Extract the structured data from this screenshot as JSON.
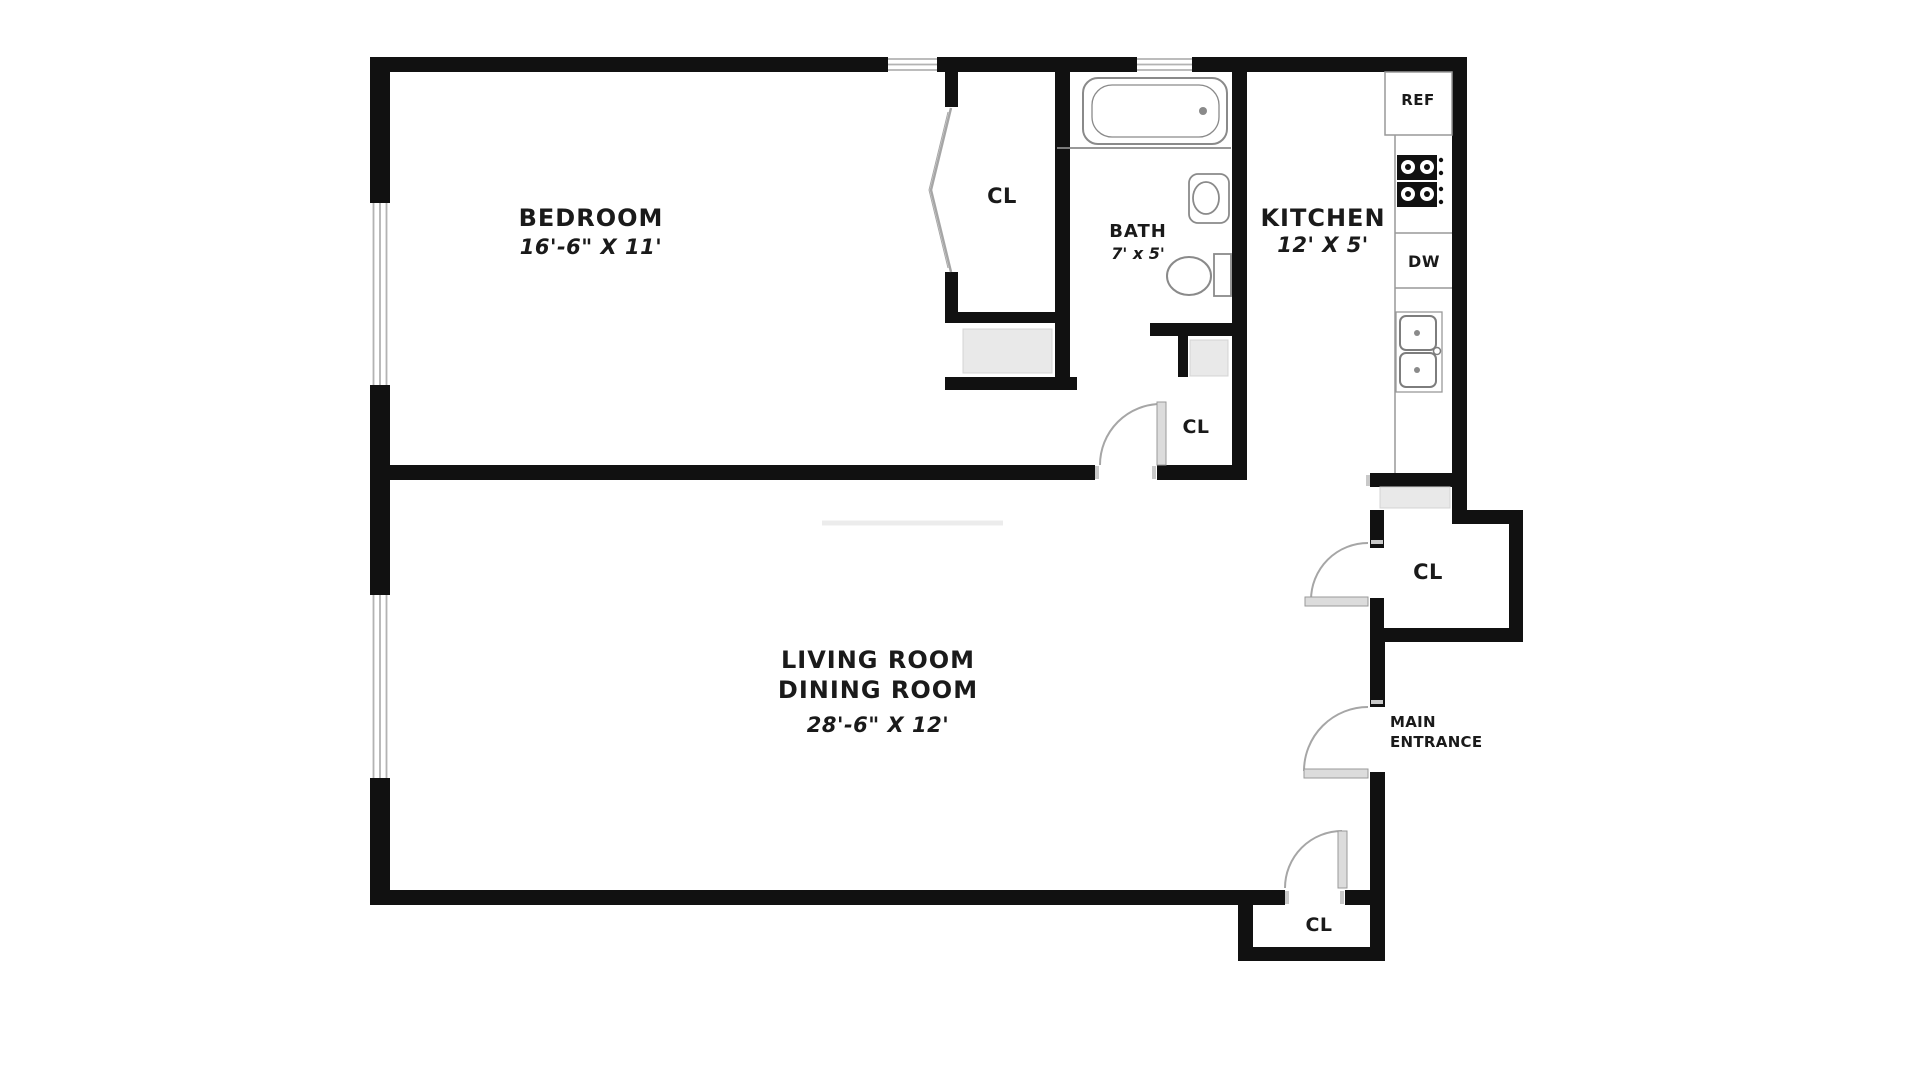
{
  "colors": {
    "wall": "#111111",
    "text": "#1a1a1a",
    "fixture_stroke": "#8a8a8a",
    "door_stroke": "#a6a6a6",
    "door_fill": "#dcdcdc",
    "window_stroke": "#b3b3b3",
    "shade": "#e9e9e9"
  },
  "rooms": {
    "bedroom": {
      "name": "BEDROOM",
      "dims": "16'-6\" X 11'"
    },
    "living_dining": {
      "line1": "LIVING ROOM",
      "line2": "DINING ROOM",
      "dims": "28'-6\" X 12'"
    },
    "bath": {
      "name": "BATH",
      "dims": "7' x 5'"
    },
    "kitchen": {
      "name": "KITCHEN",
      "dims": "12' X 5'"
    }
  },
  "labels": {
    "closet": "CL",
    "refrigerator": "REF",
    "dishwasher": "DW",
    "main_entrance_line1": "MAIN",
    "main_entrance_line2": "ENTRANCE"
  }
}
